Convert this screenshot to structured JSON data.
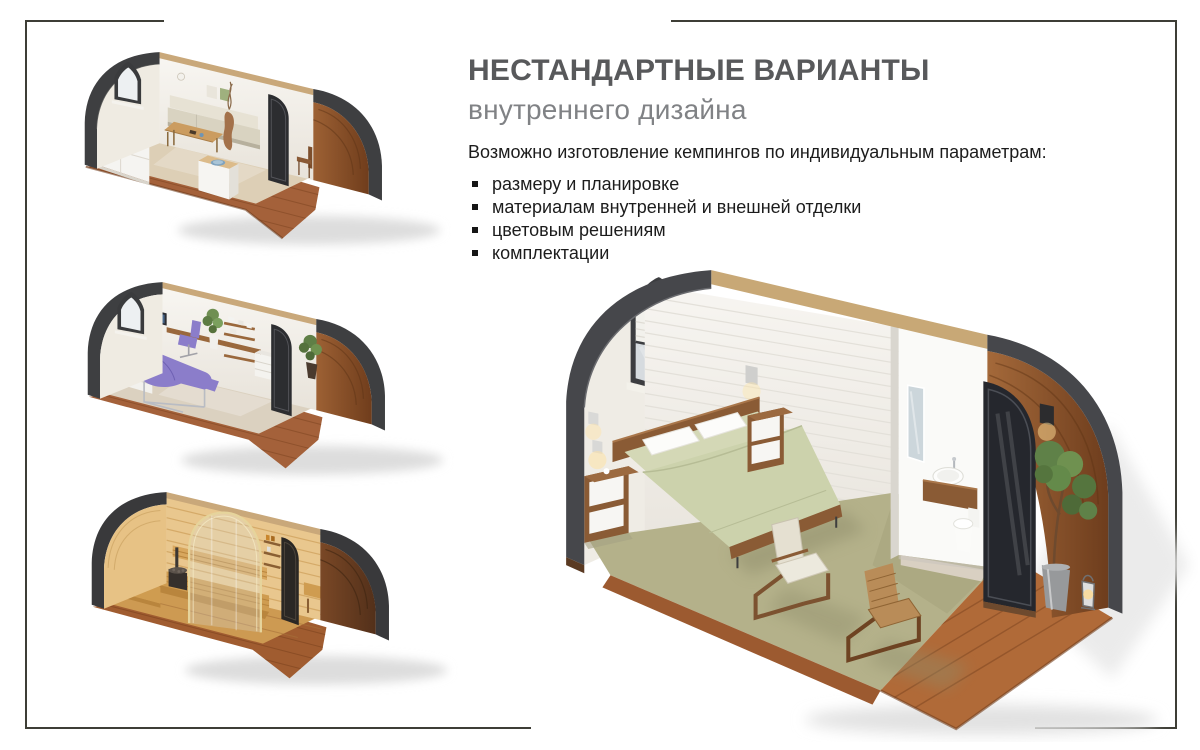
{
  "slide": {
    "background": "#ffffff",
    "frame_color": "#3e3e36"
  },
  "header": {
    "title": "НЕСТАНДАРТНЫЕ ВАРИАНТЫ",
    "subtitle": "внутреннего дизайна",
    "title_color": "#58595b",
    "subtitle_color": "#808285"
  },
  "body": {
    "intro": "Возможно изготовление кемпингов по индивидуальным параметрам:",
    "bullets": [
      "размеру и планировке",
      "материалам внутренней и внешней отделки",
      "цветовым решениям",
      "комплектации"
    ],
    "text_color": "#1c1c1c"
  },
  "images": [
    {
      "id": "pod-lounge",
      "alt": "Интерьер кемпинга: гостиная с диваном, столом и барной стойкой"
    },
    {
      "id": "pod-massage",
      "alt": "Интерьер кемпинга: массажный кабинет с кушеткой и рабочим местом"
    },
    {
      "id": "pod-sauna",
      "alt": "Интерьер кемпинга: сауна с деревянной отделкой"
    },
    {
      "id": "pod-bedroom",
      "alt": "Интерьер кемпинга: спальня с кроватью, санузлом и террасой"
    }
  ]
}
